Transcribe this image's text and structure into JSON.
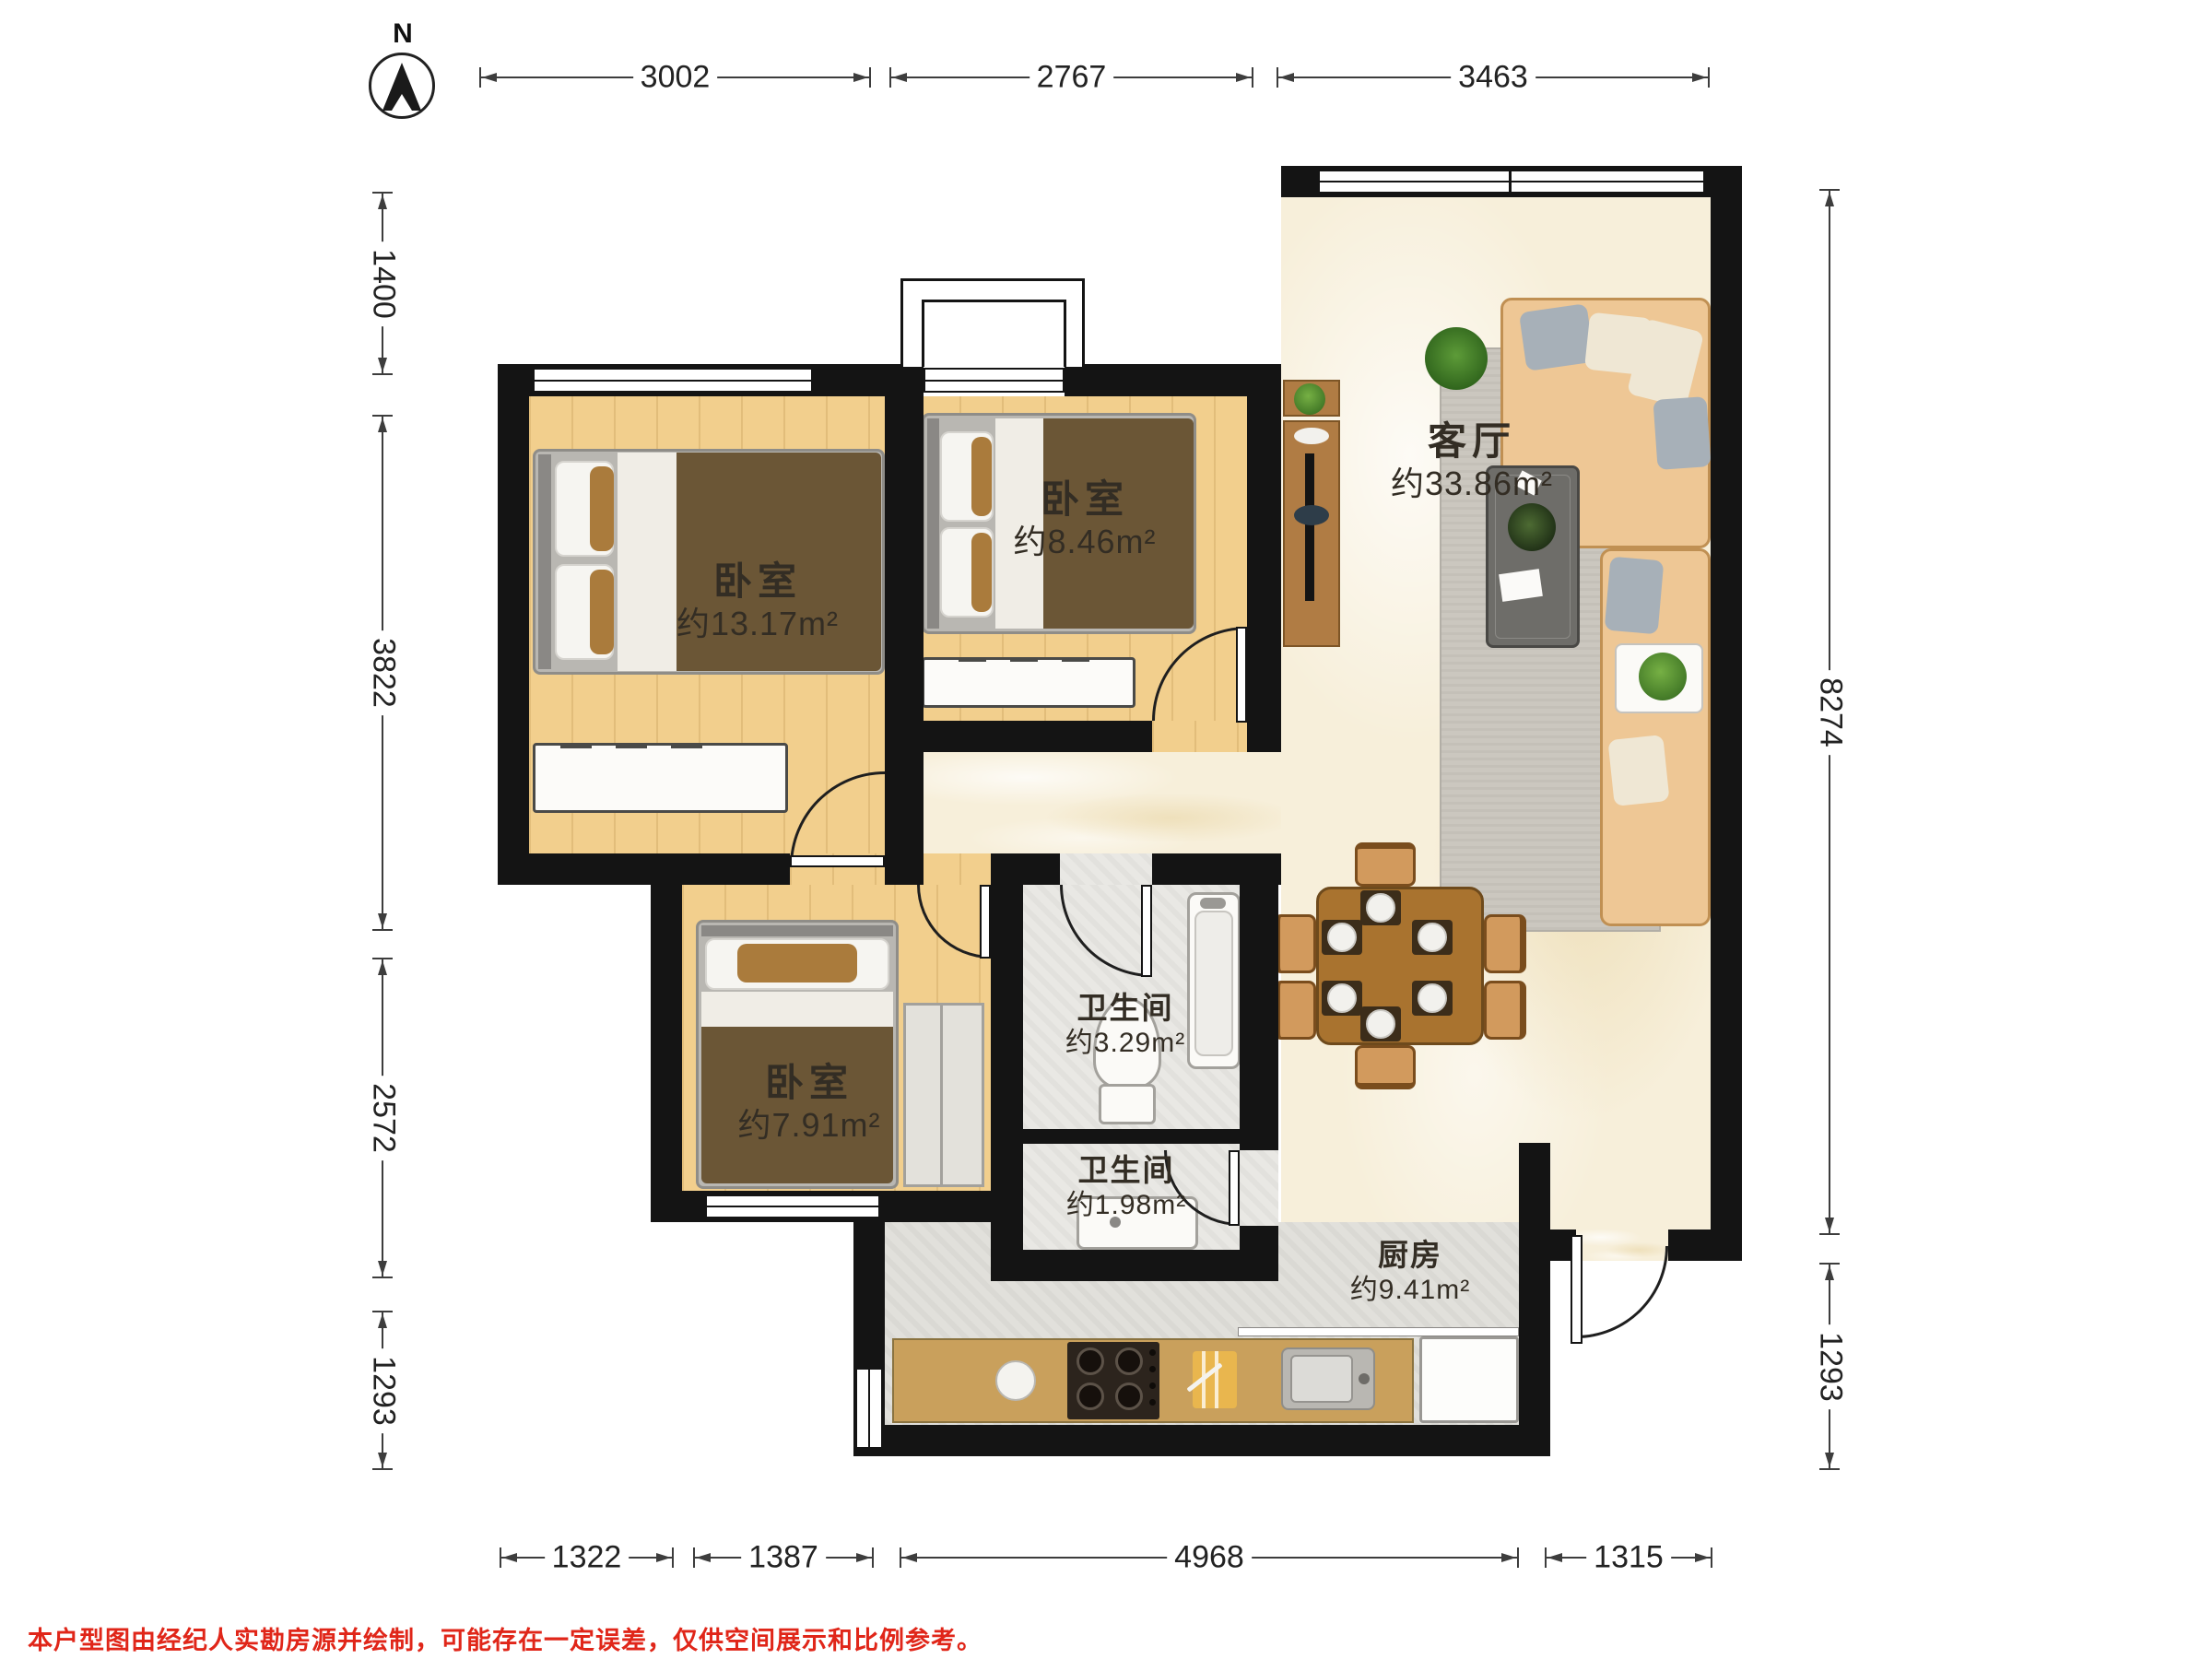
{
  "compass": {
    "north_label": "N"
  },
  "dims": {
    "top": [
      "3002",
      "2767",
      "3463"
    ],
    "left": [
      "1400",
      "3822",
      "2572",
      "1293"
    ],
    "right": [
      "8274",
      "1293"
    ],
    "bottom": [
      "1322",
      "1387",
      "4968",
      "1315"
    ]
  },
  "rooms": {
    "bedroom_main": {
      "name": "卧室",
      "area": "约13.17m²"
    },
    "bedroom_mid": {
      "name": "卧室",
      "area": "约8.46m²"
    },
    "bedroom_small": {
      "name": "卧室",
      "area": "约7.91m²"
    },
    "living_room": {
      "name": "客厅",
      "area": "约33.86m²"
    },
    "bathroom_main": {
      "name": "卫生间",
      "area": "约3.29m²"
    },
    "bathroom_small": {
      "name": "卫生间",
      "area": "约1.98m²"
    },
    "kitchen": {
      "name": "厨房",
      "area": "约9.41m²"
    }
  },
  "footer": {
    "disclaimer": "本户型图由经纪人实勘房源并绘制，可能存在一定误差，仅供空间展示和比例参考。"
  },
  "colors": {
    "wall": "#141414",
    "wood_floor": "#f2cf8d",
    "marble_floor": "#f7efda",
    "tile_floor": "#e9e8e4",
    "kitchen_floor": "#e1e0db",
    "bed_brown": "#6b5636",
    "sofa": "#eec795",
    "dining_table": "#a9732f",
    "counter": "#c9a05c",
    "dimension_line": "#3d3d3d",
    "disclaimer_red": "#e02619"
  }
}
